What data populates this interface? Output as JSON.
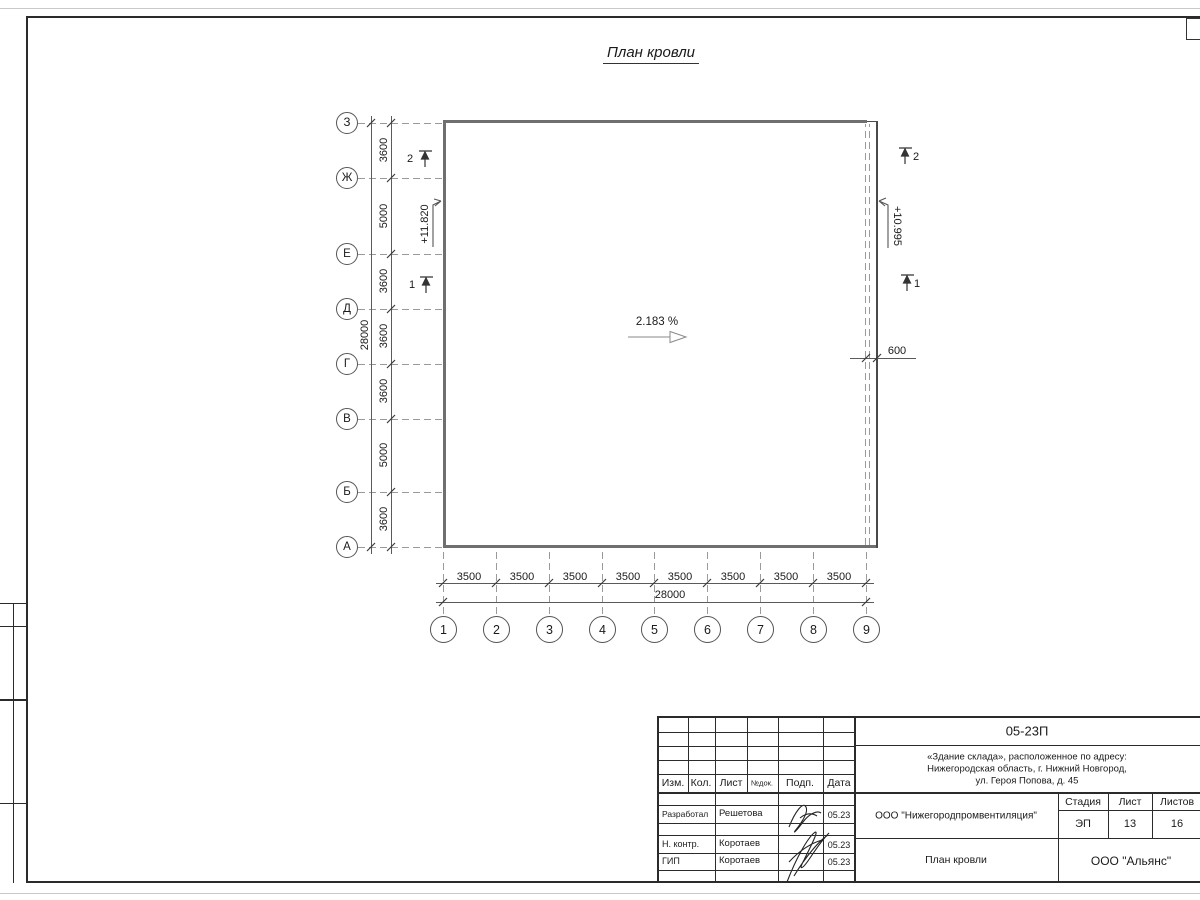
{
  "colors": {
    "line": "#2b2b2b",
    "roof_edge": "#6f6f6f",
    "dashed_axis": "#9a9a9a"
  },
  "sheet": {
    "title": "План кровли"
  },
  "plan": {
    "slope": "2.183 %",
    "elevation_left": "+11.820",
    "elevation_right": "+10.995",
    "overhang_dim": "600",
    "row_axes": [
      "З",
      "Ж",
      "Е",
      "Д",
      "Г",
      "В",
      "Б",
      "А"
    ],
    "row_dims": [
      "3600",
      "5000",
      "3600",
      "3600",
      "3600",
      "5000",
      "3600"
    ],
    "row_total": "28000",
    "col_axes": [
      "1",
      "2",
      "3",
      "4",
      "5",
      "6",
      "7",
      "8",
      "9"
    ],
    "col_dims": [
      "3500",
      "3500",
      "3500",
      "3500",
      "3500",
      "3500",
      "3500",
      "3500"
    ],
    "col_total": "28000",
    "sections": {
      "one": "1",
      "two": "2"
    }
  },
  "titleblock": {
    "doc_number": "05-23П",
    "object_line1": "«Здание склада», расположенное по адресу:",
    "object_line2": "Нижегородская область, г. Нижний Новгород,",
    "object_line3": "ул. Героя Попова, д. 45",
    "columns": {
      "izm": "Изм.",
      "kol": "Кол.",
      "list": "Лист",
      "ndok": "№док.",
      "podp": "Подп.",
      "data": "Дата"
    },
    "signers": [
      {
        "role": "Разработал",
        "name": "Решетова",
        "date": "05.23"
      },
      {
        "role": "Н. контр.",
        "name": "Коротаев",
        "date": "05.23"
      },
      {
        "role": "ГИП",
        "name": "Коротаев",
        "date": "05.23"
      }
    ],
    "designer_org": "ООО \"Нижегородпромвентиляция\"",
    "stage_label": "Стадия",
    "sheet_label": "Лист",
    "sheets_label": "Листов",
    "stage": "ЭП",
    "sheet": "13",
    "sheets": "16",
    "drawing_title": "План кровли",
    "client_org": "ООО \"Альянс\""
  }
}
